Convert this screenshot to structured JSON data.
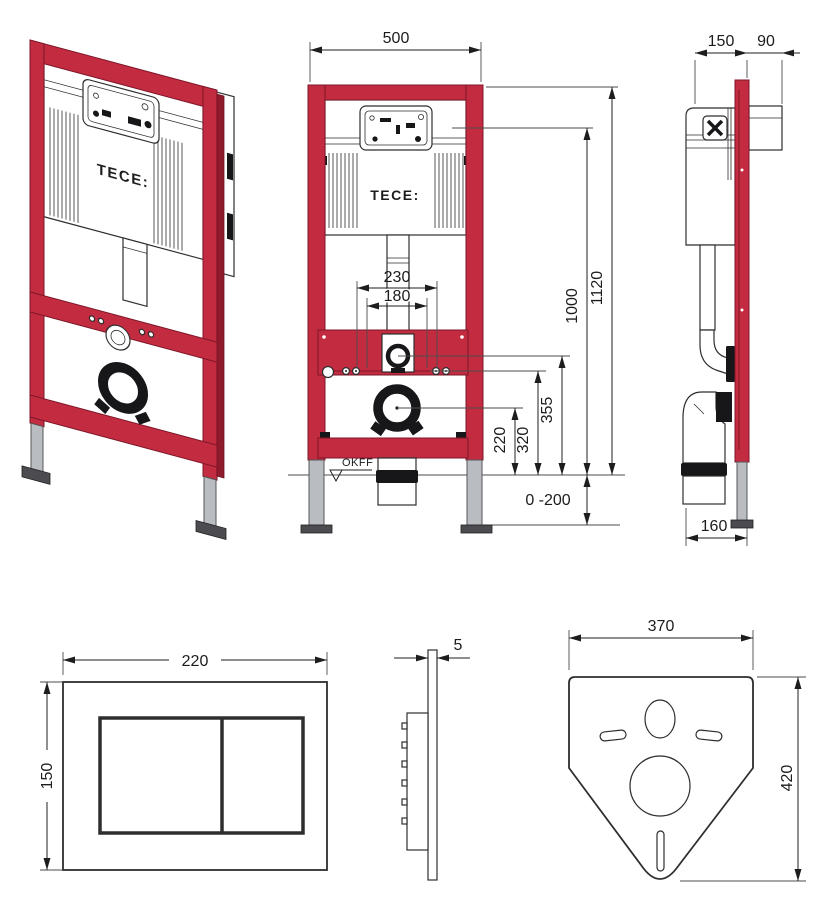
{
  "colors": {
    "frame_red": "#c22b40",
    "frame_red_dark": "#7d1528",
    "leg_gray": "#b9bcc0",
    "detail_black": "#17171a",
    "line": "#2e2e2e"
  },
  "views": {
    "iso": {
      "logo": "TECE:"
    },
    "front": {
      "logo": "TECE:",
      "floor_label": "OKFF",
      "dims": {
        "width": "500",
        "total_height": "1120",
        "flush_line_height": "1000",
        "outlet_355": "355",
        "outlet_320": "320",
        "outlet_220": "220",
        "fixing_230": "230",
        "fixing_180": "180",
        "floor_range": "0 -200"
      }
    },
    "side": {
      "dims": {
        "depth": "150",
        "front_offset": "90",
        "bottom_depth": "160"
      }
    },
    "plate_front": {
      "dims": {
        "width": "220",
        "height": "150"
      }
    },
    "plate_side": {
      "dims": {
        "thickness": "5"
      }
    },
    "mat": {
      "dims": {
        "width": "370",
        "height": "420"
      }
    }
  }
}
